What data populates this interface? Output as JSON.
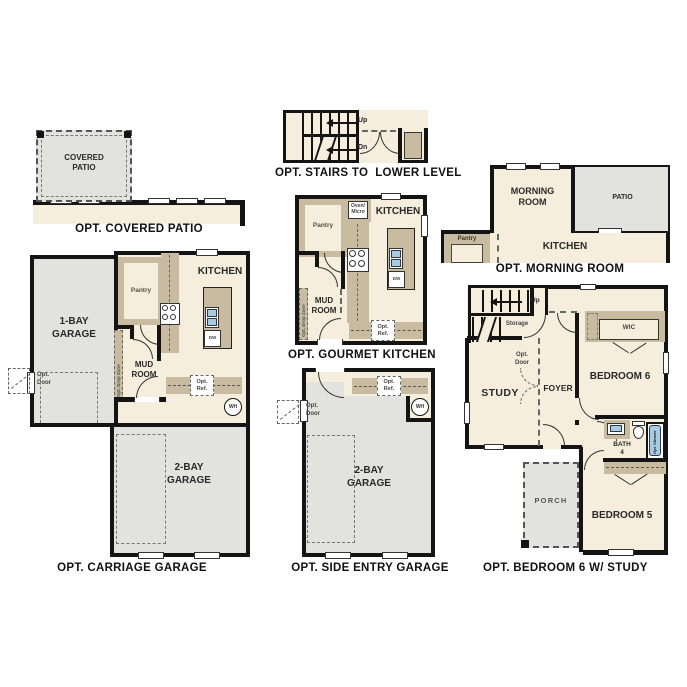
{
  "palette": {
    "floor": "#f5eedd",
    "concrete": "#e2e2df",
    "counter": "#c9bba0",
    "wall": "#141414",
    "fixture_blue": "#a6cce2"
  },
  "figures": {
    "covered_patio": {
      "caption": "OPT. COVERED PATIO",
      "room": "COVERED\nPATIO"
    },
    "stairs_lower": {
      "caption": "OPT. STAIRS TO  LOWER LEVEL",
      "up": "Up",
      "dn": "Dn"
    },
    "morning_room": {
      "caption": "OPT. MORNING ROOM",
      "morning": "MORNING\nROOM",
      "patio": "PATIO",
      "kitchen": "KITCHEN",
      "pantry": "Pantry"
    },
    "gourmet_kitchen": {
      "caption": "OPT. GOURMET KITCHEN",
      "kitchen": "KITCHEN",
      "pantry": "Pantry",
      "oven": "Oven/\nMicro",
      "mud": "MUD\nROOM",
      "dw": "DW",
      "ref": "Opt.\nRef.",
      "drop": "Opt. Drop Zone"
    },
    "carriage_garage": {
      "caption": "OPT. CARRIAGE GARAGE",
      "garage1": "1-BAY\nGARAGE",
      "garage2": "2-BAY\nGARAGE",
      "kitchen": "KITCHEN",
      "pantry": "Pantry",
      "mud": "MUD\nROOM",
      "dw": "DW",
      "ref": "Opt.\nRef.",
      "door": "Opt.\nDoor",
      "wh": "WH",
      "drop": "Opt. Drop Zone"
    },
    "side_entry": {
      "caption": "OPT. SIDE ENTRY GARAGE",
      "garage2": "2-BAY\nGARAGE",
      "ref": "Opt.\nRef.",
      "door": "Opt.\nDoor",
      "wh": "WH"
    },
    "bed6_study": {
      "caption": "OPT. BEDROOM 6 W/ STUDY",
      "study": "STUDY",
      "foyer": "FOYER",
      "bed6": "BEDROOM 6",
      "bed5": "BEDROOM 5",
      "bath": "BATH\n4",
      "wic": "WIC",
      "porch": "PORCH",
      "storage": "Storage",
      "up": "Up",
      "door": "Opt.\nDoor",
      "shower": "Opt. Shower"
    }
  }
}
